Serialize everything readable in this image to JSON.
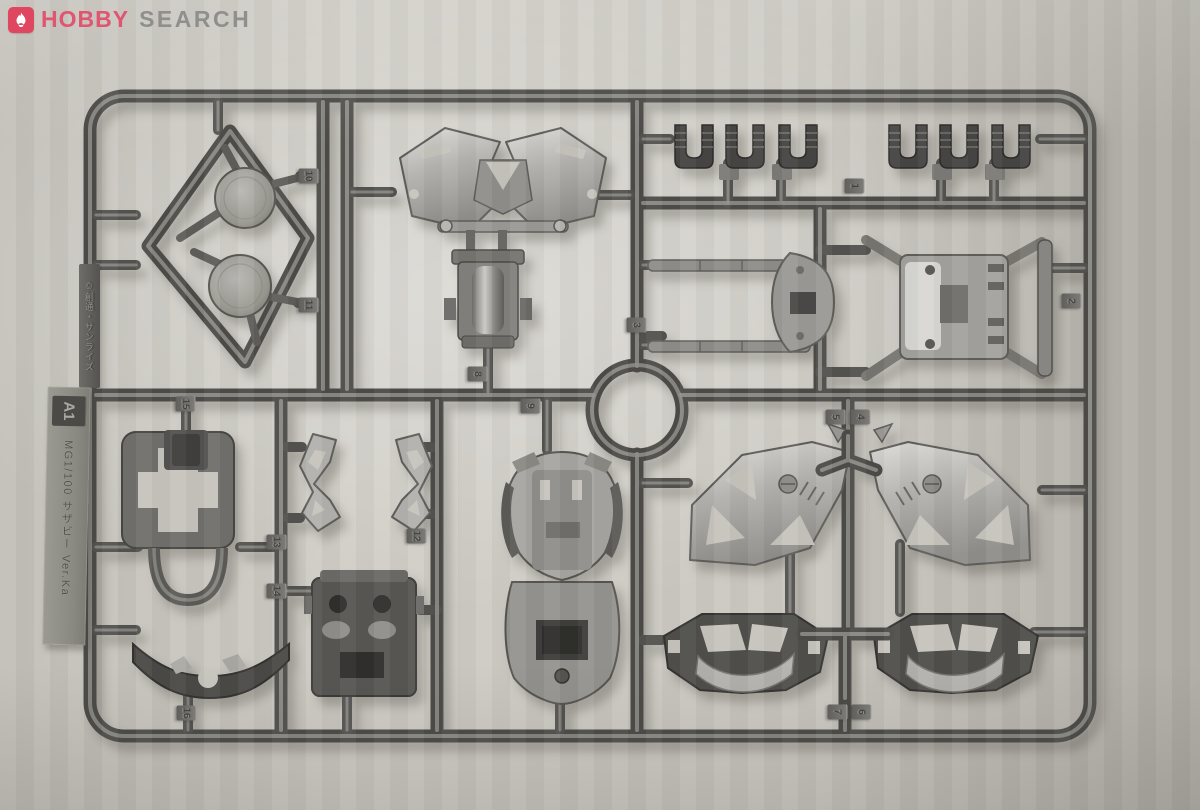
{
  "domain_note": "photograph of an injection-molded model kit runner",
  "watermark": {
    "icon": "flame-icon",
    "brand_primary": "HOBBY",
    "brand_secondary": "SEARCH",
    "brand_color": "#df4760",
    "secondary_color": "#8f8f8d"
  },
  "runner": {
    "copyright": "©創通・サンライズ",
    "plate": {
      "code": "A1",
      "kit": "MG1/100 サザビー Ver.Ka"
    },
    "tags": [
      {
        "label": "1"
      },
      {
        "label": "2"
      },
      {
        "label": "3"
      },
      {
        "label": "4"
      },
      {
        "label": "5"
      },
      {
        "label": "6"
      },
      {
        "label": "7"
      },
      {
        "label": "8"
      },
      {
        "label": "9"
      },
      {
        "label": "10"
      },
      {
        "label": "11"
      },
      {
        "label": "12"
      },
      {
        "label": "13"
      },
      {
        "label": "14"
      },
      {
        "label": "15"
      },
      {
        "label": "16"
      }
    ],
    "colors": {
      "plastic_dark": "#4c4b48",
      "plastic_mid": "#6b6a67",
      "plastic_bright": "#b7b6b2",
      "background": "#cbc8c1"
    }
  }
}
